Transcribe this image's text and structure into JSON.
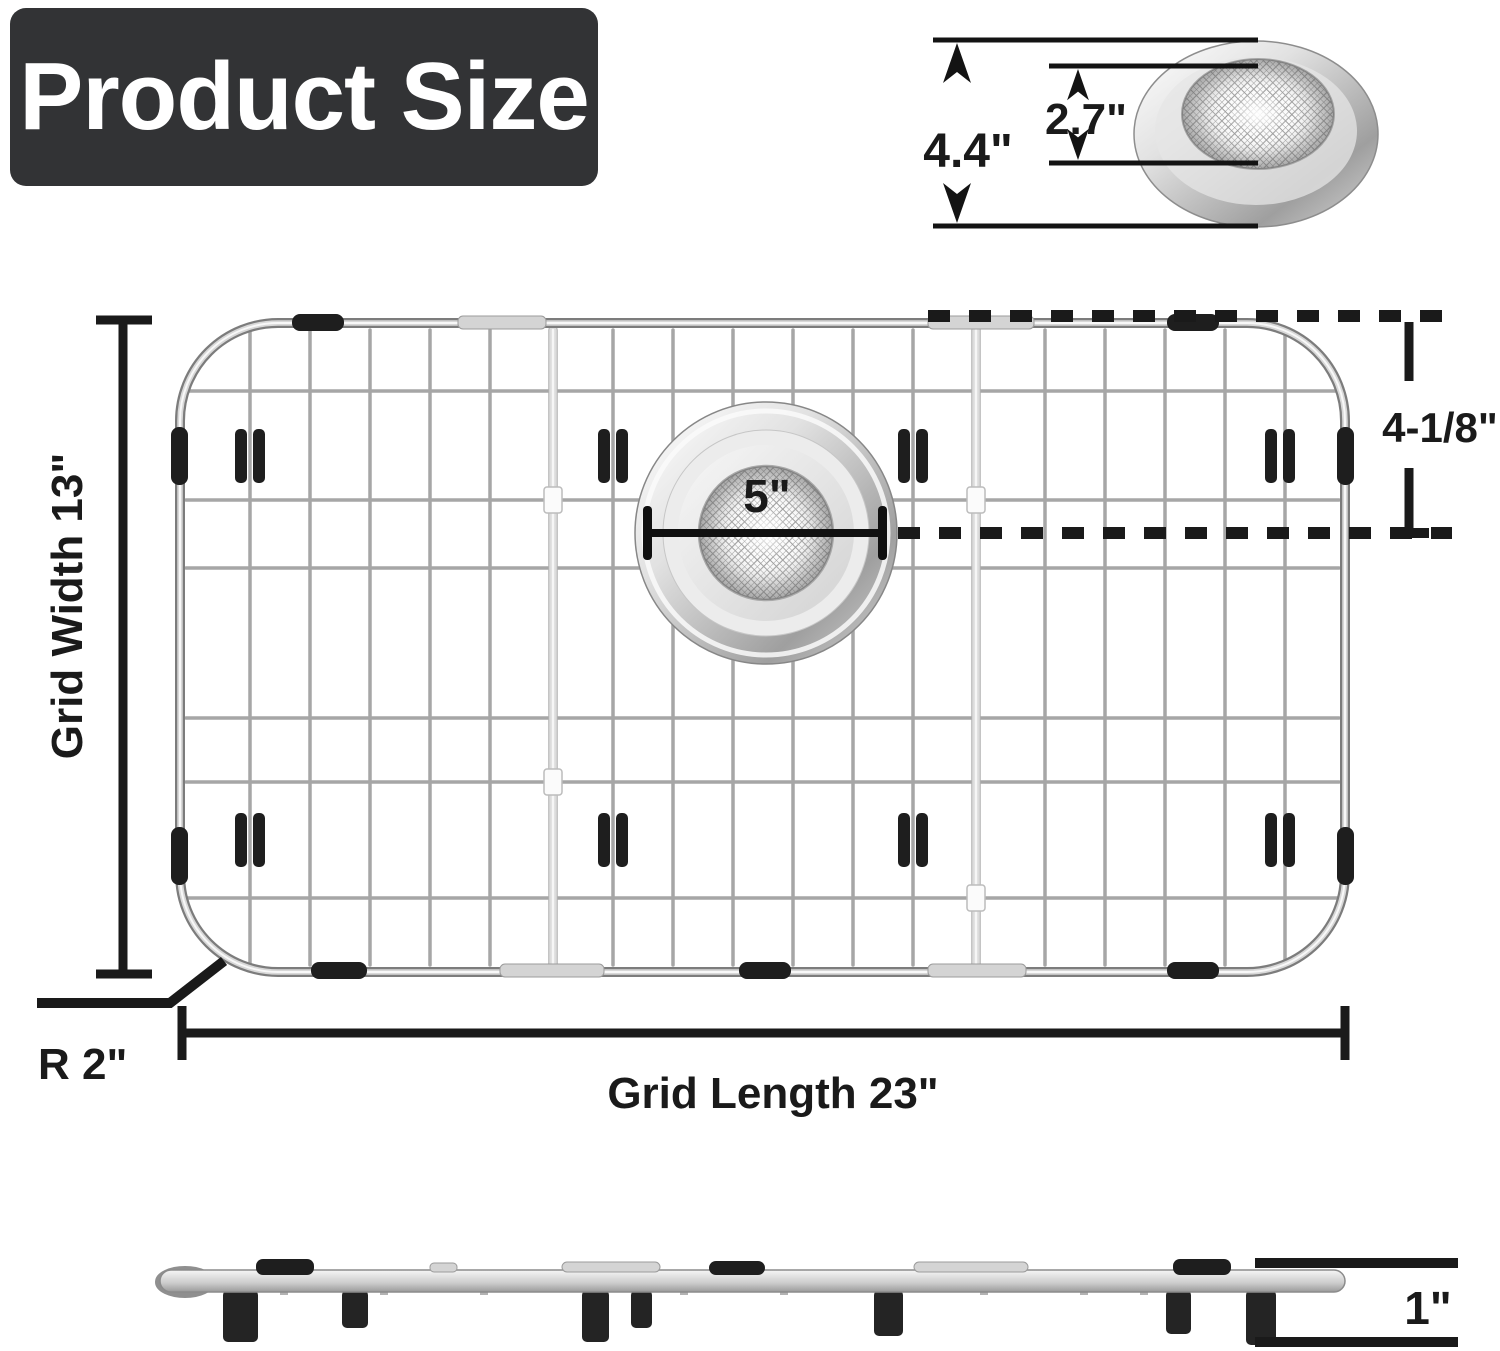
{
  "title": {
    "label": "Product Size"
  },
  "top_strainer": {
    "outer_diameter": "4.4\"",
    "mesh_diameter": "2.7\""
  },
  "grid": {
    "width_label": "Grid Width 13\"",
    "length_label": "Grid Length 23\"",
    "corner_radius_label": "R 2\"",
    "drain_diameter_label": "5\"",
    "drain_offset_label": "4-1/8\""
  },
  "side_view": {
    "height_label": "1\""
  },
  "colors": {
    "title_bg": "#323335",
    "title_fg": "#ffffff",
    "dimension_ink": "#1a1a1a",
    "wire_metal": "#a6a6a6",
    "rubber": "#1e1e1e"
  }
}
